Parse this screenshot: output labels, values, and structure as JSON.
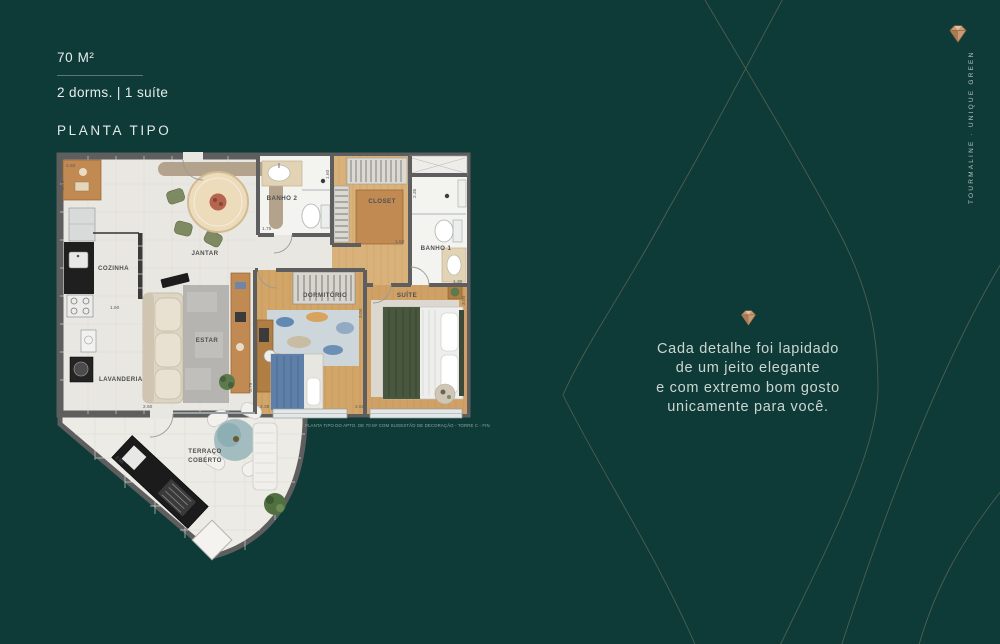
{
  "header": {
    "area": "70 M²",
    "config": "2 dorms. | 1 suíte",
    "section_title": "PLANTA TIPO"
  },
  "quote": {
    "lines": [
      "Cada detalhe foi lapidado",
      "de um jeito elegante",
      "e com extremo bom gosto",
      "unicamente para você."
    ]
  },
  "brand": {
    "vertical": "TOURMALINE · UNIQUE GREEN"
  },
  "colors": {
    "background": "#0e3b38",
    "curve_line": "#8e8267",
    "gem_copper": "#c59a74",
    "quote_text": "#ccd6d1"
  },
  "floorplan": {
    "caption": "PLANTA TIPO DO APTO. DE 70 M² COM SUGESTÃO DE DECORAÇÃO - TORRE C - FINAL 3",
    "rooms": {
      "cozinha": "COZINHA",
      "jantar": "JANTAR",
      "estar": "ESTAR",
      "lavanderia": "LAVANDERIA",
      "banho2": "BANHO 2",
      "closet": "CLOSET",
      "banho1": "BANHO 1",
      "dormitorio": "DORMITÓRIO",
      "suite": "SUÍTE",
      "terraco1": "TERRAÇO",
      "terraco2": "COBERTO"
    },
    "dims": {
      "counter_top": "4.50",
      "wall_left": "2.70",
      "cozinha": "1.60",
      "banho2_w": "1.75",
      "banho2_h": "1.60",
      "banho1_h": "2.35",
      "closet_w": "1.52",
      "banho1_w": "1.30",
      "dorm_h": "3.04",
      "estar_h": "3.79",
      "dorm_w1": "2.38",
      "dorm_w2": "2.62",
      "suite_h": "3.00",
      "estar_w": "2.60",
      "terraco_diag": "2.65"
    }
  }
}
